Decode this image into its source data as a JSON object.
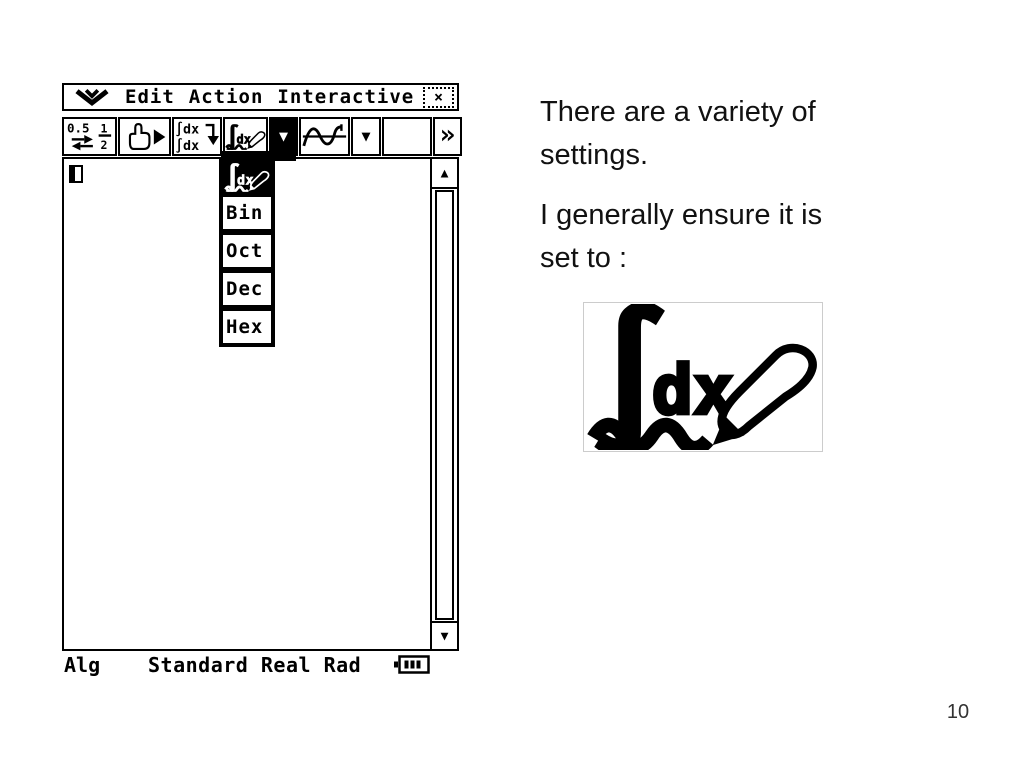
{
  "slide": {
    "page_number": "10",
    "paragraph1": {
      "line1": "There are a variety of",
      "line2": "settings."
    },
    "paragraph2": {
      "line1": "I generally ensure it is",
      "line2": "set to :"
    }
  },
  "calculator": {
    "menu_bar": {
      "apps_icon": "double-chevron-down-icon",
      "items": [
        {
          "label": "Edit"
        },
        {
          "label": "Action"
        },
        {
          "label": "Interactive"
        }
      ],
      "close_icon": "close-icon"
    },
    "toolbar": {
      "buttons": [
        {
          "name": "fraction-decimal-toggle",
          "icon": "decimal-fraction-swap-icon"
        },
        {
          "name": "select-pointer",
          "icon": "hand-pointer-icon"
        },
        {
          "name": "transform-expression",
          "icon": "integral-transform-icon"
        },
        {
          "name": "main-app",
          "icon": "integral-dx-stylus-icon"
        },
        {
          "name": "main-app-dropdown",
          "icon": "dropdown-arrow-icon",
          "pressed": true
        },
        {
          "name": "graph",
          "icon": "graph-curve-icon"
        },
        {
          "name": "graph-dropdown",
          "icon": "dropdown-arrow-icon",
          "pressed": false
        },
        {
          "name": "spacer",
          "icon": ""
        },
        {
          "name": "more-tools",
          "icon": "double-chevron-right-icon"
        }
      ],
      "frac_button": {
        "decimal": "0.5",
        "numerator": "1",
        "denominator": "2"
      },
      "transform_button": {
        "line1": "∫dx",
        "line2": "∫dx"
      }
    },
    "dropdown_menu": {
      "selected_icon": "integral-dx-stylus-icon",
      "items": [
        {
          "label": "Bin"
        },
        {
          "label": "Oct"
        },
        {
          "label": "Dec"
        },
        {
          "label": "Hex"
        }
      ]
    },
    "status_bar": {
      "mode": "Alg",
      "settings": "Standard Real Rad",
      "battery_icon": "battery-icon"
    },
    "icons": {
      "close": "×",
      "dropdown_arrow": "▼",
      "more_chevron": "»",
      "scroll_up": "▲",
      "scroll_down": "▼",
      "integral": "∫",
      "dx_label": "dx"
    }
  },
  "colors": {
    "ink": "#000000",
    "paper": "#ffffff",
    "page_number": "#333333"
  }
}
